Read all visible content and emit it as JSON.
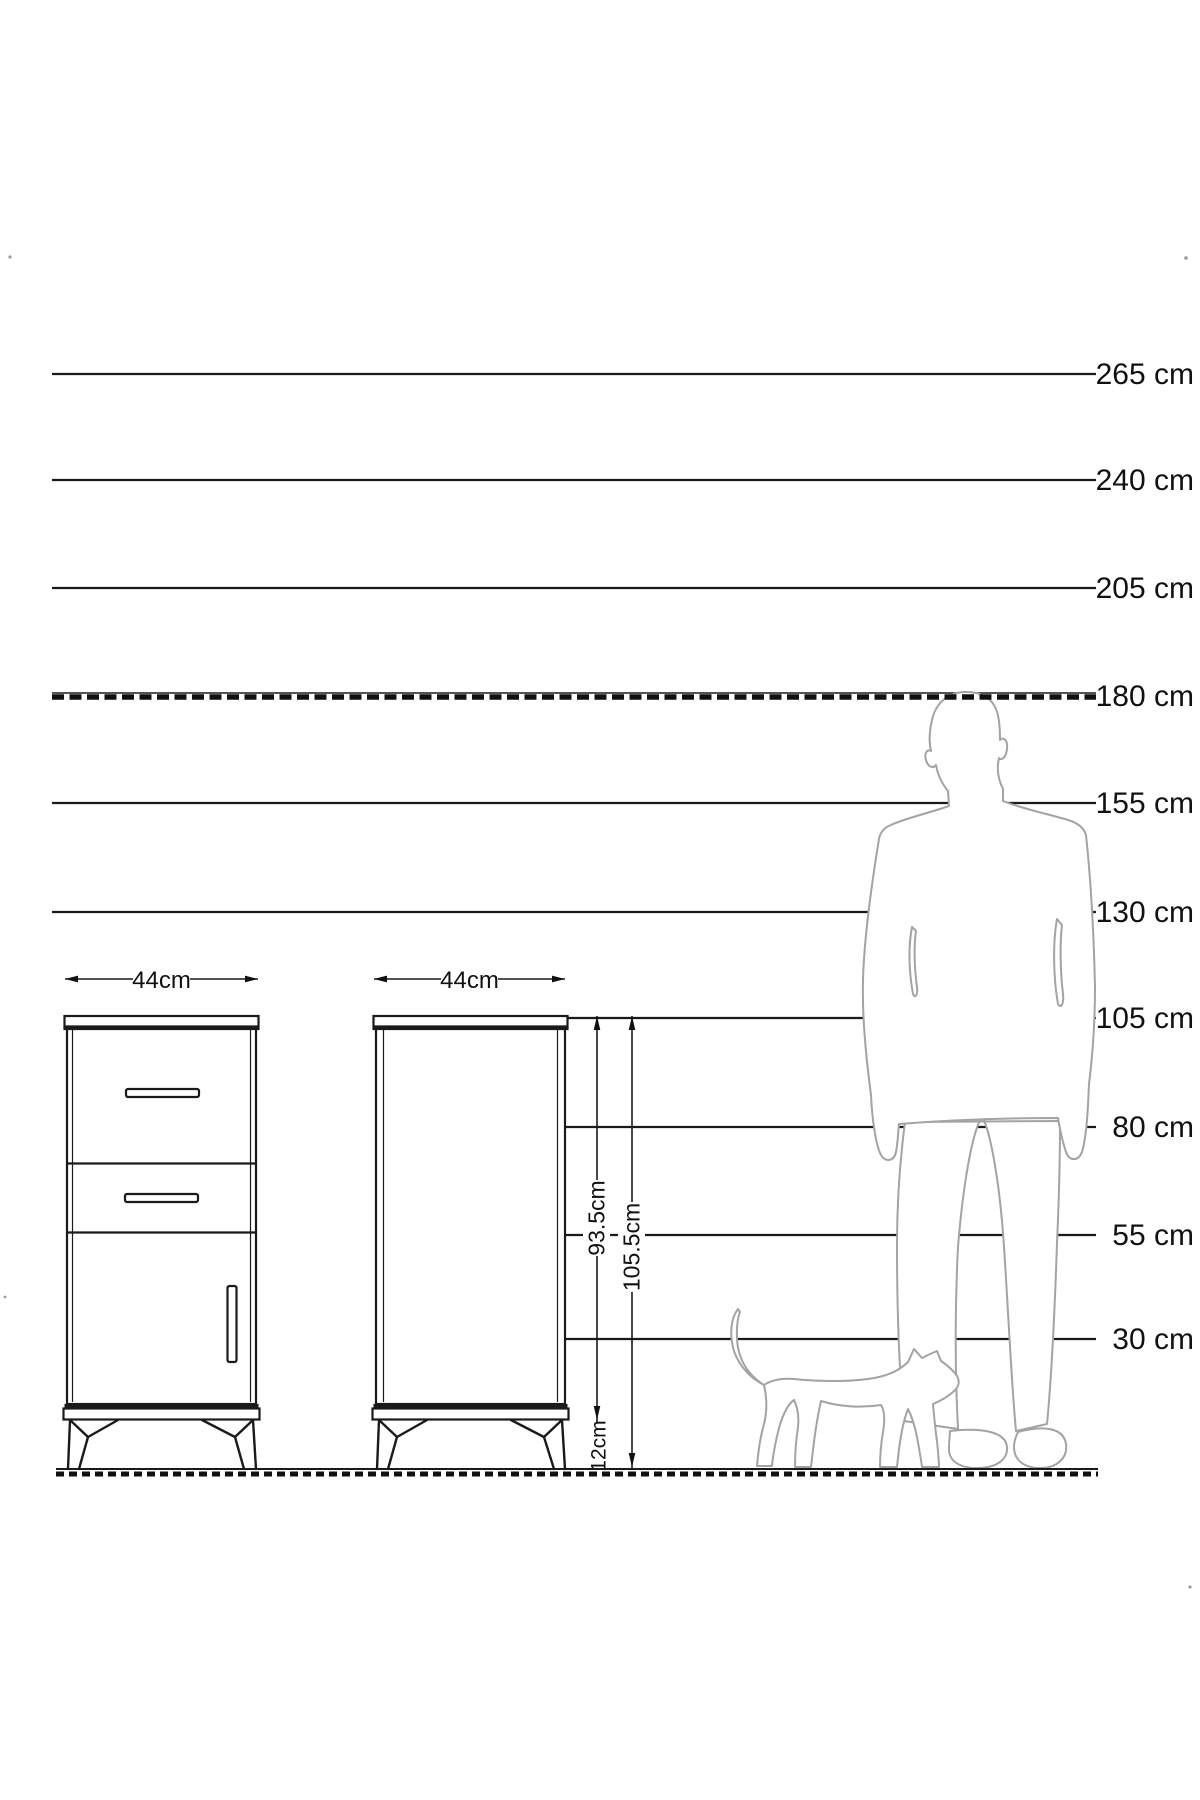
{
  "diagram": {
    "kind": "furniture-size-reference-diagram",
    "unit": "cm",
    "colors": {
      "line": "#1a1a1a",
      "silhouette": "#a3a3a3",
      "background": "#ffffff",
      "text": "#111111"
    }
  },
  "height_scale": {
    "label_align_x": 1194,
    "lines": [
      {
        "cm": 265,
        "label": "265 cm",
        "y": 374,
        "x1": 52,
        "x2": 1096,
        "style": "solid"
      },
      {
        "cm": 240,
        "label": "240 cm",
        "y": 480,
        "x1": 52,
        "x2": 1096,
        "style": "solid"
      },
      {
        "cm": 205,
        "label": "205 cm",
        "y": 588,
        "x1": 52,
        "x2": 1096,
        "style": "solid"
      },
      {
        "cm": 180,
        "label": "180 cm",
        "y": 696,
        "x1": 52,
        "x2": 1096,
        "style": "dashed"
      },
      {
        "cm": 155,
        "label": "155 cm",
        "y": 803,
        "x1": 52,
        "x2": 1096,
        "style": "solid"
      },
      {
        "cm": 130,
        "label": "130 cm",
        "y": 912,
        "x1": 52,
        "x2": 1096,
        "style": "solid"
      },
      {
        "cm": 105,
        "label": "105 cm",
        "y": 1018,
        "x1": 564,
        "x2": 1096,
        "style": "solid"
      },
      {
        "cm": 80,
        "label": "80 cm",
        "y": 1127,
        "x1": 564,
        "x2": 1096,
        "style": "solid"
      },
      {
        "cm": 55,
        "label": "55 cm",
        "y": 1235,
        "x1": 564,
        "x2": 1096,
        "style": "solid"
      },
      {
        "cm": 30,
        "label": "30 cm",
        "y": 1339,
        "x1": 564,
        "x2": 1096,
        "style": "solid"
      }
    ],
    "ground_y": 1469
  },
  "dimensions": {
    "front_width": "44cm",
    "side_width": "44cm",
    "body_height": "93.5cm",
    "total_height": "105.5cm",
    "leg_height": "12cm"
  },
  "figures": {
    "man": "man-silhouette-180cm",
    "cat": "cat-silhouette"
  }
}
